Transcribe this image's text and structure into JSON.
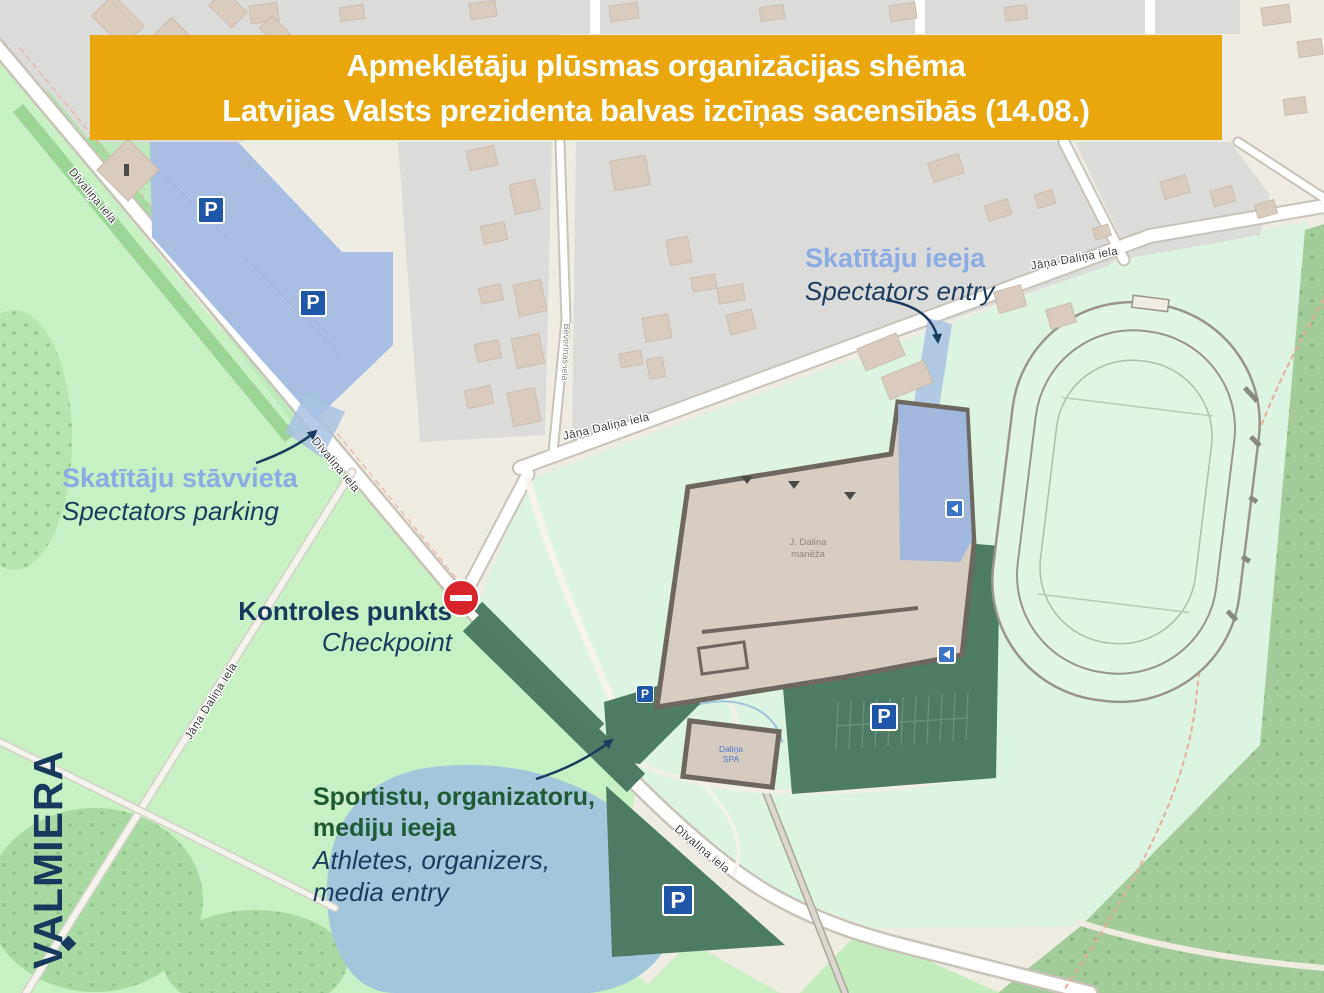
{
  "banner": {
    "line1": "Apmeklētāju plūsmas organizācijas shēma",
    "line2": "Latvijas Valsts prezidenta balvas izcīņas sacensībās (14.08.)"
  },
  "city": {
    "name": "VALMIERA"
  },
  "annotations": {
    "spectators_entry": {
      "lv": "Skatītāju ieeja",
      "en": "Spectators entry"
    },
    "spectators_parking": {
      "lv": "Skatītāju stāvvieta",
      "en": "Spectators parking"
    },
    "checkpoint": {
      "lv": "Kontroles punkts",
      "en": "Checkpoint"
    },
    "athletes_entry": {
      "lv1": "Sportistu, organizatoru,",
      "lv2": "mediju ieeja",
      "en1": "Athletes, organizers,",
      "en2": "media entry"
    }
  },
  "streets": {
    "divalina": "Dīvaliņa iela",
    "jana_dalina": "Jāņa Daliņa iela",
    "beverinas": "Beverīnas iela"
  },
  "buildings": {
    "manege1": "J. Daliņa",
    "manege2": "manēža",
    "spa1": "Daliņa",
    "spa2": "SPA"
  },
  "icons": {
    "parking": "P"
  },
  "colors": {
    "banner_bg": "#EAA70D",
    "banner_text": "#FFFFFF",
    "label_light_blue": "#8CACE2",
    "label_navy": "#1C3C5E",
    "label_green": "#1E5B35",
    "parking_area_blue": "#A9BEE3",
    "restricted_green": "#4E7B63",
    "parking_sign_blue": "#1E56A8",
    "no_entry_red": "#D8252B",
    "park_green": "#C9EFC4",
    "sports_green": "#DCF4E1",
    "lake_blue": "#A2C7DB"
  }
}
